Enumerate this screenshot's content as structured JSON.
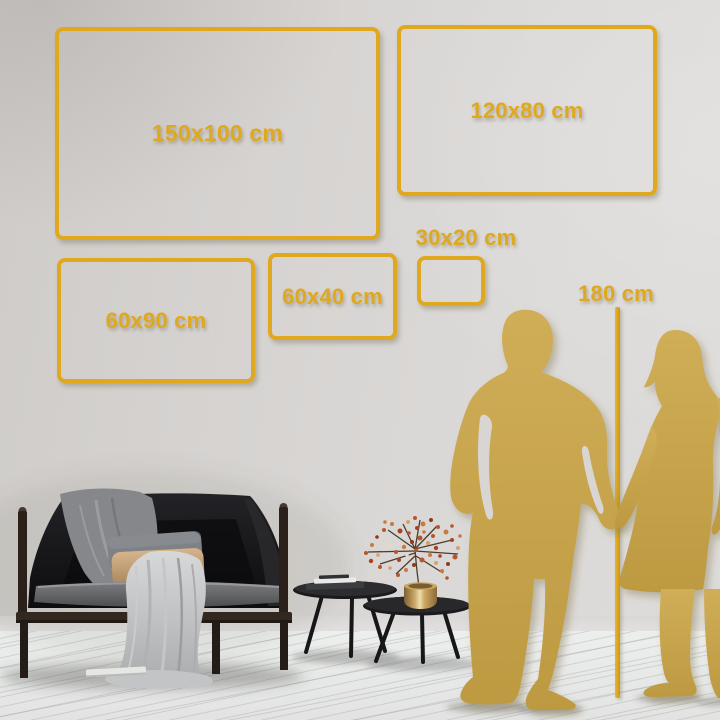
{
  "title": "Wall art size comparison guide",
  "colors": {
    "gold": "#DFA81E",
    "silhouette_gold": "#C8A64D",
    "wall_gray": "#D6D3D1",
    "floor_white": "#ECEEED",
    "sofa_black": "#17171A",
    "wood_brown": "#2B211A",
    "brass_vase": "#D8B878",
    "blanket_gray": "#C7C9CA"
  },
  "size_frames": [
    {
      "label": "150x100 cm"
    },
    {
      "label": "120x80 cm"
    },
    {
      "label": "60x90 cm"
    },
    {
      "label": "60x40 cm"
    },
    {
      "label": "30x20 cm"
    }
  ],
  "height_ruler": {
    "label": "180 cm"
  },
  "scene": {
    "elements": [
      "man-silhouette",
      "woman-silhouette",
      "sofa-with-draped-blankets",
      "gray-pillow",
      "tan-pillow",
      "nesting-coffee-tables",
      "stacked-books",
      "brass-vase-with-flower-branch",
      "wood-plank-floor"
    ]
  }
}
